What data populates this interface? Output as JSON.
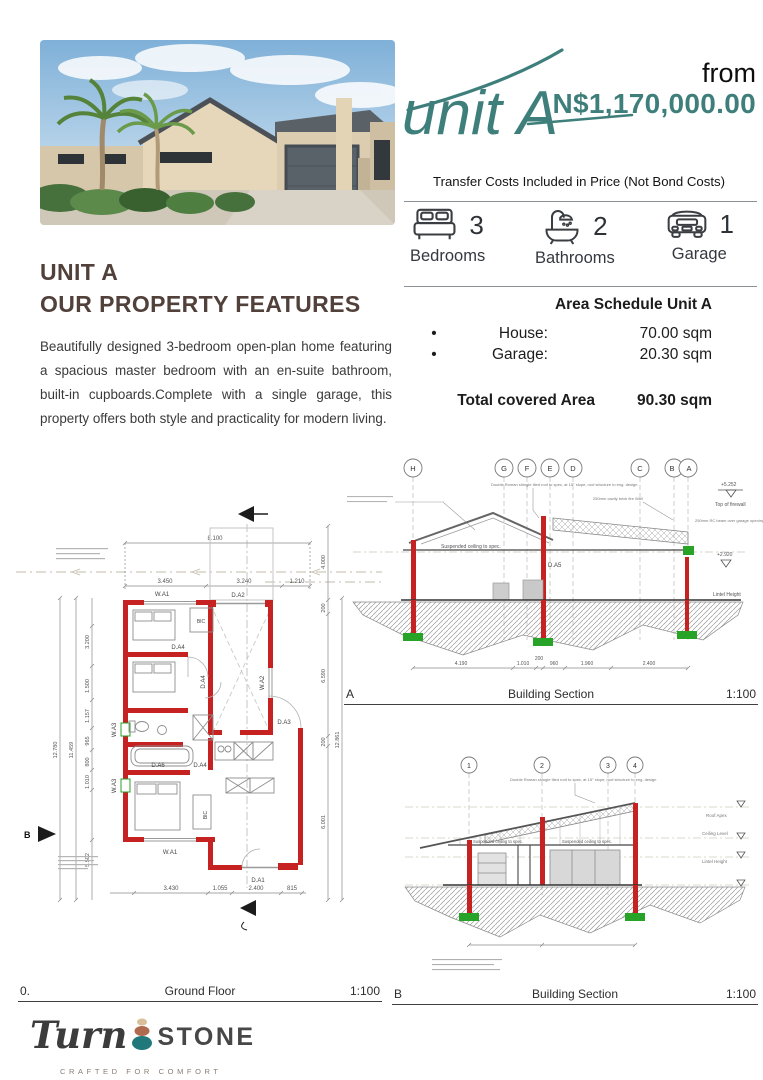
{
  "header": {
    "unit_script": "unit A",
    "from_label": "from",
    "price": "N$1,170,000.00",
    "transfer_note": "Transfer Costs Included in Price (Not Bond Costs)"
  },
  "features": {
    "items": [
      {
        "icon": "bed-icon",
        "count": "3",
        "label": "Bedrooms"
      },
      {
        "icon": "bath-icon",
        "count": "2",
        "label": "Bathrooms"
      },
      {
        "icon": "car-icon",
        "count": "1",
        "label": "Garage"
      }
    ]
  },
  "area_schedule": {
    "title": "Area Schedule Unit A",
    "rows": [
      {
        "bullet": "•",
        "label": "House:",
        "value": "70.00 sqm"
      },
      {
        "bullet": "•",
        "label": "Garage:",
        "value": "20.30 sqm"
      }
    ],
    "total_label": "Total covered Area",
    "total_value": "90.30 sqm"
  },
  "property": {
    "title_line1": "UNIT A",
    "title_line2": "OUR PROPERTY FEATURES",
    "description": "Beautifully designed 3-bedroom open-plan home featuring a spacious master bedroom with an en-suite bathroom, built-in cupboards.Complete with a single garage, this property offers both style and practicality for modern living."
  },
  "ground_floor": {
    "number": "0.",
    "title": "Ground Floor",
    "scale": "1:100",
    "labels": {
      "wa1_top": "W.A1",
      "da2": "D.A2",
      "bic1": "BIC",
      "bic2": "BIC",
      "da4_a": "D.A4",
      "da4_b": "D.A4",
      "da4_c": "D.A4",
      "da6": "D.A6",
      "da3": "D.A3",
      "wa2": "W.A2",
      "wa3_a": "W.A3",
      "wa3_b": "W.A3",
      "wa1_bottom": "W.A1",
      "da1": "D.A1",
      "b_marker": "B"
    },
    "dims": {
      "overall_top": "8.100",
      "top": [
        "3.450",
        "3.240",
        "1.210"
      ],
      "bottom": [
        "3.430",
        "1.055",
        "2.400",
        "815"
      ],
      "left_overall": "12.780",
      "left_inner": "11.459",
      "left": [
        "3.200",
        "1.500",
        "1.157",
        "965",
        "800",
        "1.010",
        "5.502"
      ],
      "right": [
        "4.000",
        "200",
        "6.590",
        "200",
        "6.001"
      ],
      "right_overall": "12.861"
    }
  },
  "section_a": {
    "letter": "A",
    "title": "Building Section",
    "scale": "1:100",
    "grid": [
      "H",
      "G",
      "F",
      "E",
      "D",
      "C",
      "B",
      "A"
    ],
    "annotations": {
      "roof_note": "Double Roman shingle tiled roof to spec, at 15° slope, roof structure to eng. design",
      "fire_wall": "250mm cavity brick fire Wall",
      "rc_beam": "250mm RC beam over garage opening, Plaster & Painted",
      "ceiling": "Suspended ceiling to spec.",
      "level_top": "+5.252",
      "level_top_label": "Top of firewall",
      "level_lintel": "+2.920",
      "lintel_label": "Lintel Height",
      "da5": "D.A5"
    },
    "dims": [
      "4.190",
      "1.010",
      "200",
      "960",
      "1.960",
      "2.400"
    ]
  },
  "section_b": {
    "letter": "B",
    "title": "Building Section",
    "scale": "1:100",
    "grid": [
      "1",
      "2",
      "3",
      "4"
    ],
    "annotations": {
      "ceiling_1": "Suspended ceiling to spec.",
      "ceiling_2": "Suspended ceiling to spec.",
      "roof_apex": "Roof Apex",
      "ceiling_level": "Ceiling Level",
      "lintel": "Lintel Height"
    }
  },
  "logo": {
    "turn": "Turn",
    "stone": "STONE",
    "tagline": "CRAFTED FOR COMFORT"
  },
  "colors": {
    "teal": "#3E7F7B",
    "brown": "#52423A",
    "wall_red": "#C62222",
    "footing_green": "#27A327"
  }
}
